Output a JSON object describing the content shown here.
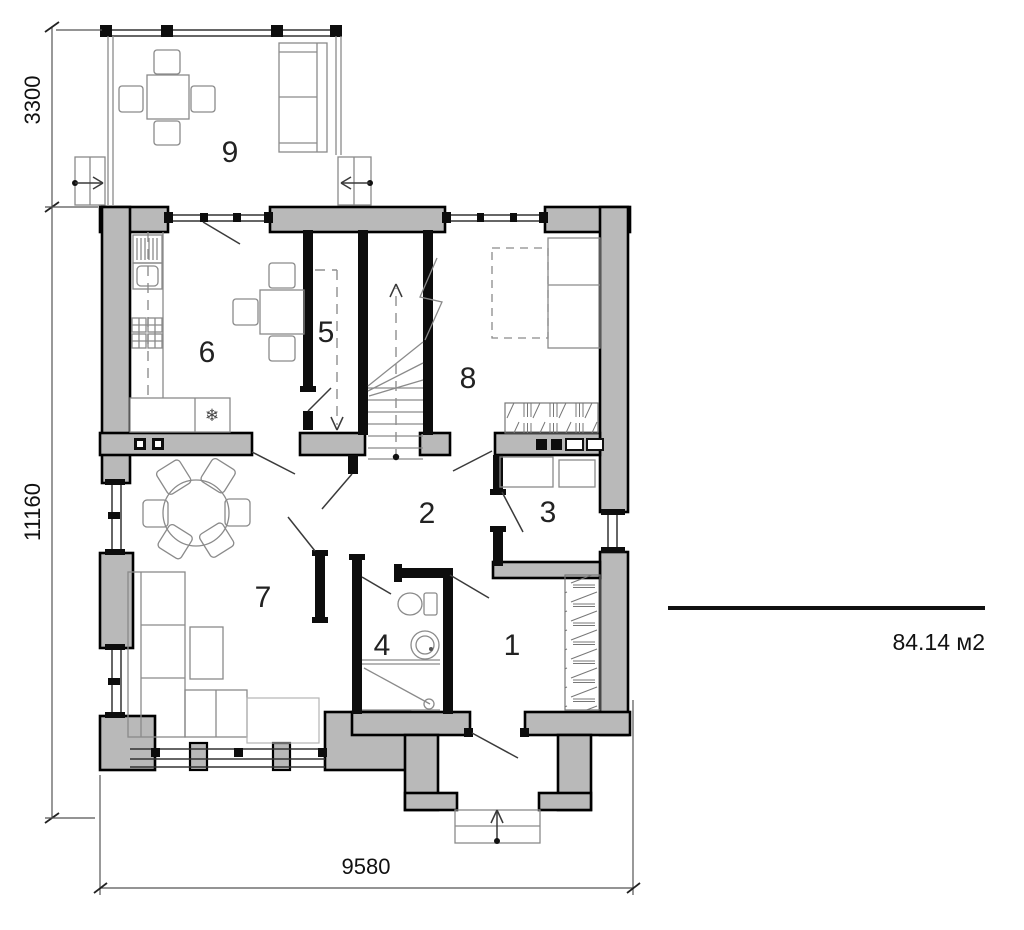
{
  "plan": {
    "rooms": [
      {
        "num": "1"
      },
      {
        "num": "2"
      },
      {
        "num": "3"
      },
      {
        "num": "4"
      },
      {
        "num": "5"
      },
      {
        "num": "6"
      },
      {
        "num": "7"
      },
      {
        "num": "8"
      },
      {
        "num": "9"
      }
    ],
    "dimensions": {
      "terrace_depth": "3300",
      "total_depth": "11160",
      "total_width": "9580"
    },
    "area_label": "84.14 м2",
    "symbols": {
      "freezer": "❄"
    },
    "colors": {
      "wall_fill": "#b9b9b9",
      "outline": "#000000",
      "furniture_stroke": "#8a8a8a"
    }
  }
}
